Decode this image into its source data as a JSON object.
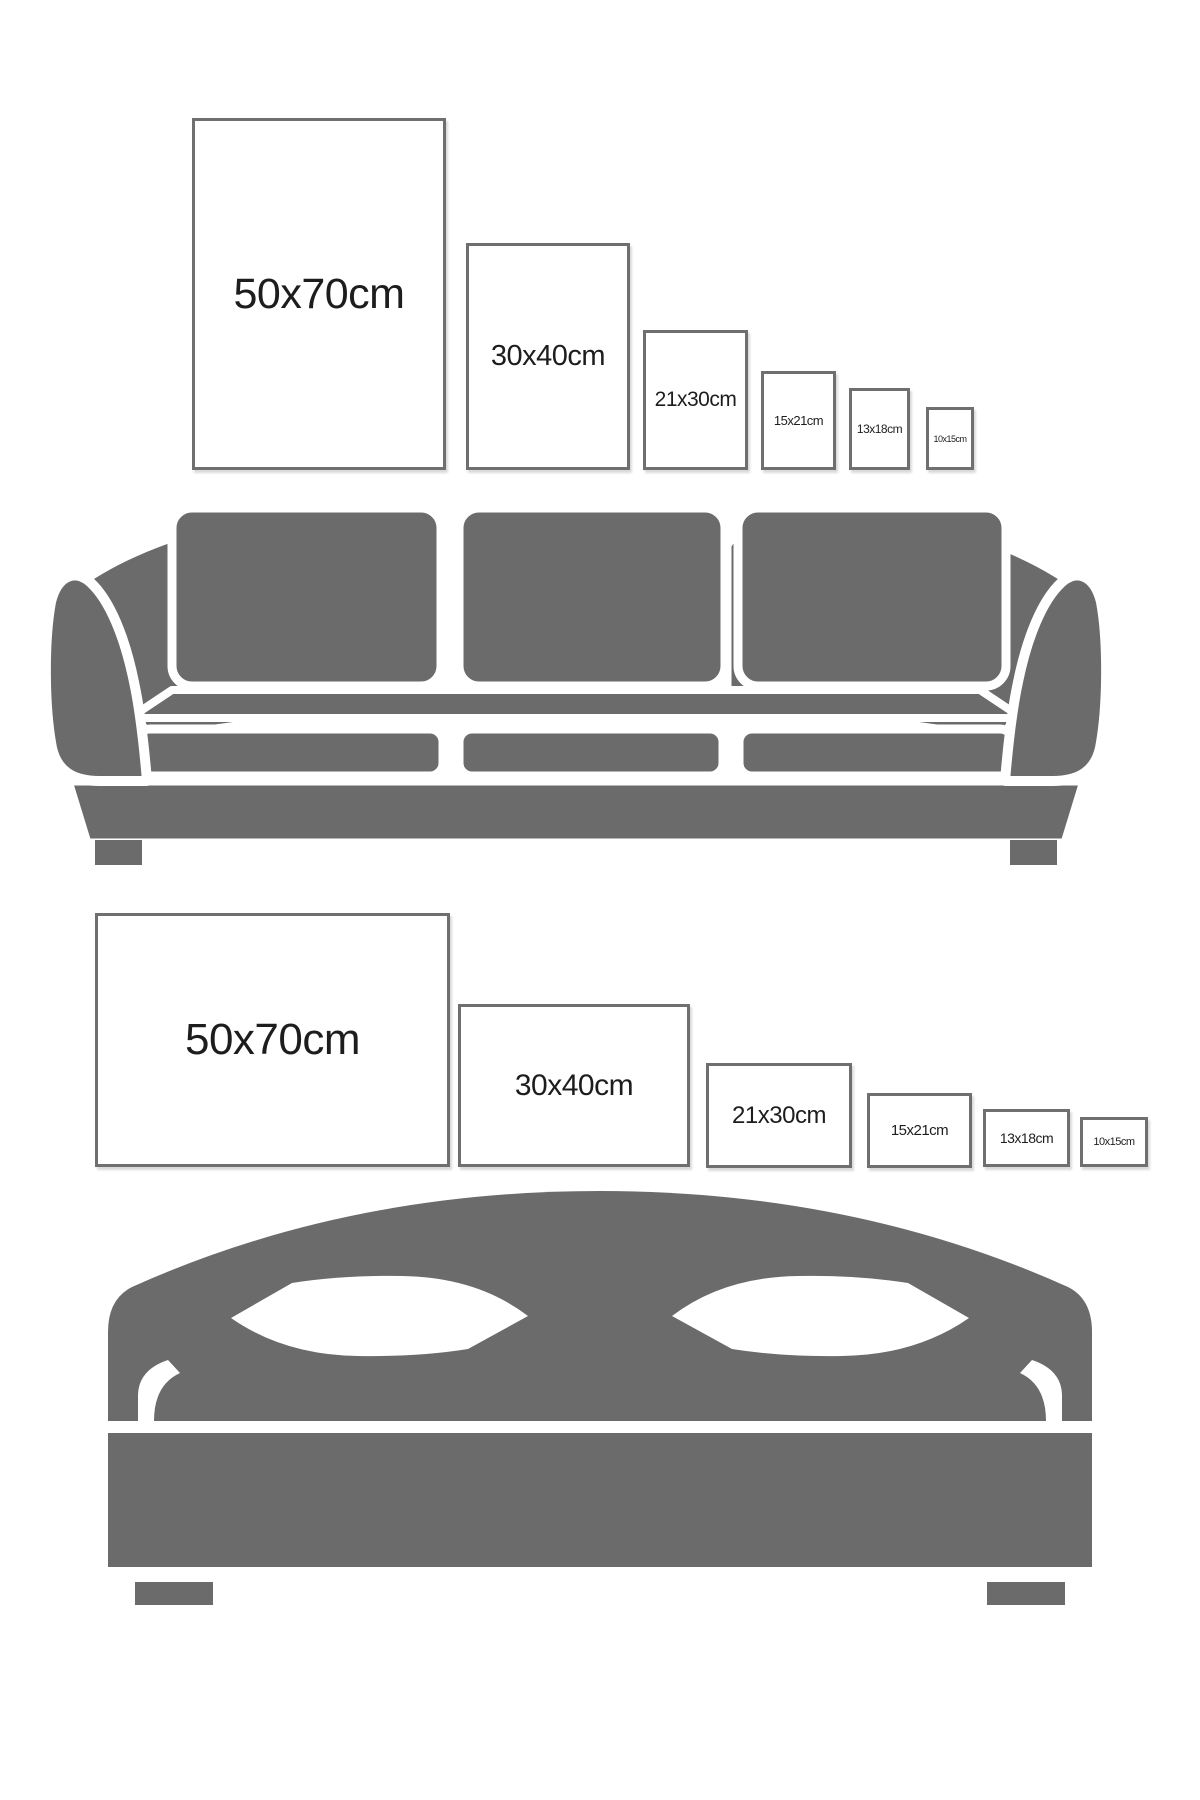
{
  "colors": {
    "background": "#ffffff",
    "furniture": "#6b6b6b",
    "frame_border": "#6f6f6f",
    "label_text": "#1d1d1d"
  },
  "sections": [
    {
      "id": "sofa",
      "furniture": "sofa",
      "frames": [
        {
          "label": "50x70cm",
          "x": 192,
          "y": 118,
          "w": 254,
          "h": 352,
          "font": 43
        },
        {
          "label": "30x40cm",
          "x": 466,
          "y": 243,
          "w": 164,
          "h": 227,
          "font": 29
        },
        {
          "label": "21x30cm",
          "x": 643,
          "y": 330,
          "w": 105,
          "h": 140,
          "font": 21
        },
        {
          "label": "15x21cm",
          "x": 761,
          "y": 371,
          "w": 75,
          "h": 99,
          "font": 13
        },
        {
          "label": "13x18cm",
          "x": 849,
          "y": 388,
          "w": 61,
          "h": 82,
          "font": 12
        },
        {
          "label": "10x15cm",
          "x": 926,
          "y": 407,
          "w": 48,
          "h": 63,
          "font": 9
        }
      ]
    },
    {
      "id": "bed",
      "furniture": "bed",
      "frames": [
        {
          "label": "50x70cm",
          "x": 95,
          "y": 913,
          "w": 355,
          "h": 254,
          "font": 44
        },
        {
          "label": "30x40cm",
          "x": 458,
          "y": 1004,
          "w": 232,
          "h": 163,
          "font": 30
        },
        {
          "label": "21x30cm",
          "x": 706,
          "y": 1063,
          "w": 146,
          "h": 105,
          "font": 24
        },
        {
          "label": "15x21cm",
          "x": 867,
          "y": 1093,
          "w": 105,
          "h": 75,
          "font": 15
        },
        {
          "label": "13x18cm",
          "x": 983,
          "y": 1109,
          "w": 87,
          "h": 58,
          "font": 14
        },
        {
          "label": "10x15cm",
          "x": 1080,
          "y": 1117,
          "w": 68,
          "h": 50,
          "font": 11
        }
      ]
    }
  ]
}
